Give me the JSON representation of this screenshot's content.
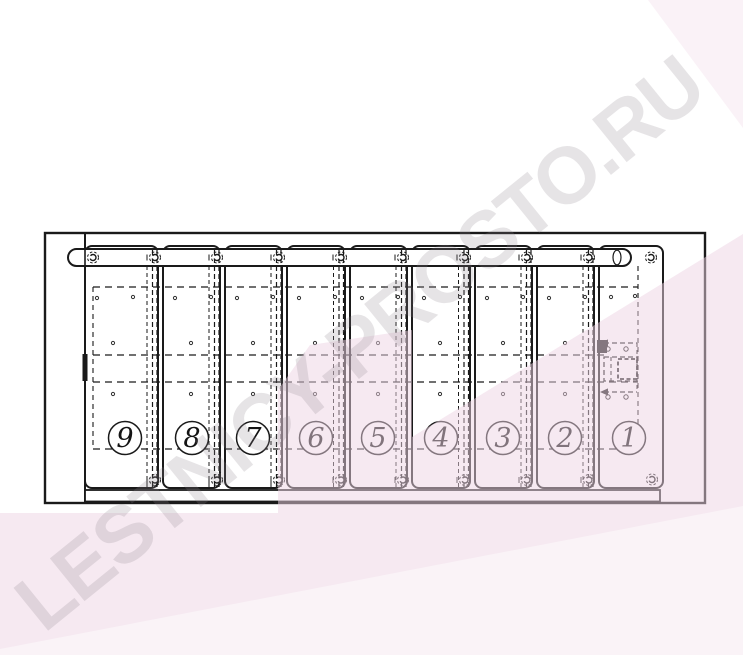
{
  "watermark": {
    "text": "LESTNICY-PROSTO.RU"
  },
  "diagram": {
    "position_labels": [
      "9",
      "8",
      "7",
      "6",
      "5",
      "4",
      "3",
      "2",
      "1"
    ]
  },
  "colors": {
    "line": "#1a1a1a",
    "paper": "#ffffff",
    "pink_tint": "rgba(238,211,228,0.5)",
    "pink_tint_light": "rgba(238,211,228,0.3)",
    "watermark_gray": "rgba(143,131,139,0.22)"
  }
}
